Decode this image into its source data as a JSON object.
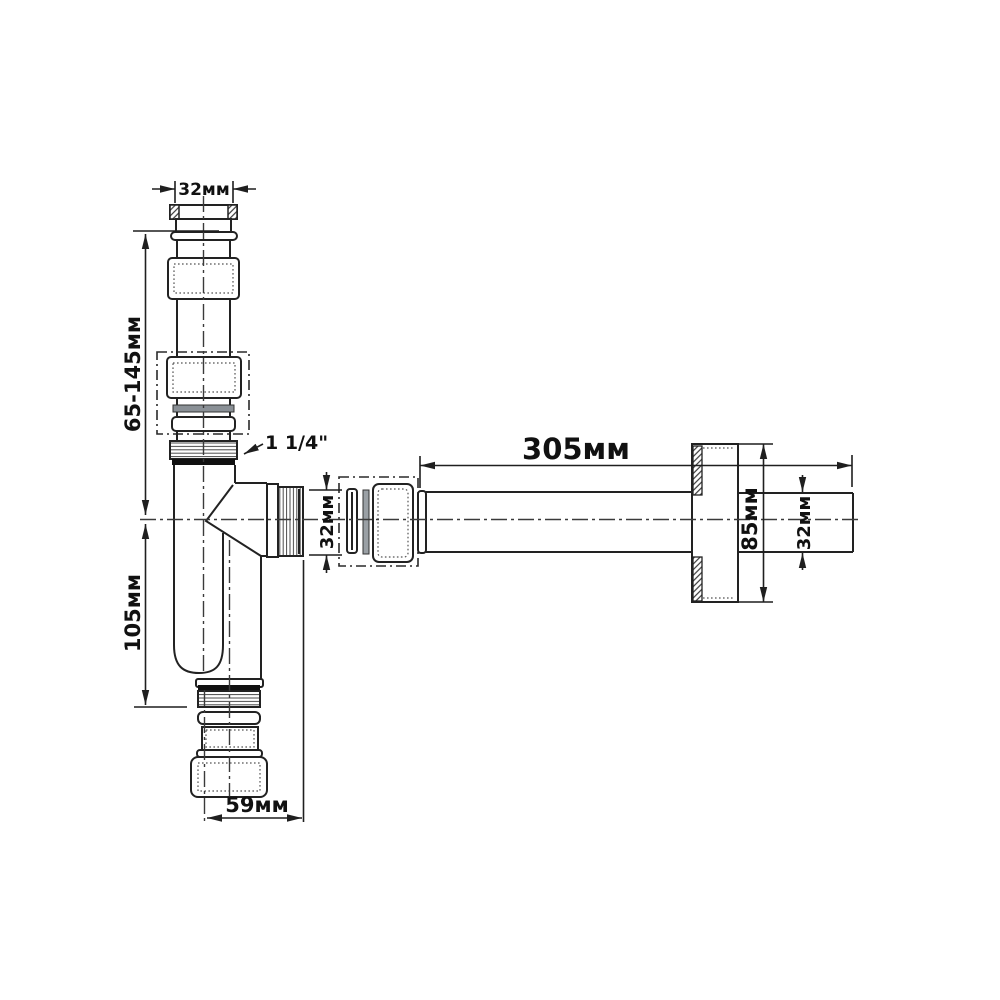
{
  "drawing": {
    "background": "#ffffff",
    "line_color": "#222222",
    "text_color": "#111111",
    "labels": {
      "top_diameter": "32мм",
      "adjustable_height": "65-145мм",
      "thread_size": "1 1/4\"",
      "body_height": "105мм",
      "bottom_offset": "59мм",
      "outlet_length": "305мм",
      "outlet_connection_diameter": "32мм",
      "escutcheon_diameter": "85мм",
      "outlet_pipe_diameter": "32мм"
    }
  }
}
